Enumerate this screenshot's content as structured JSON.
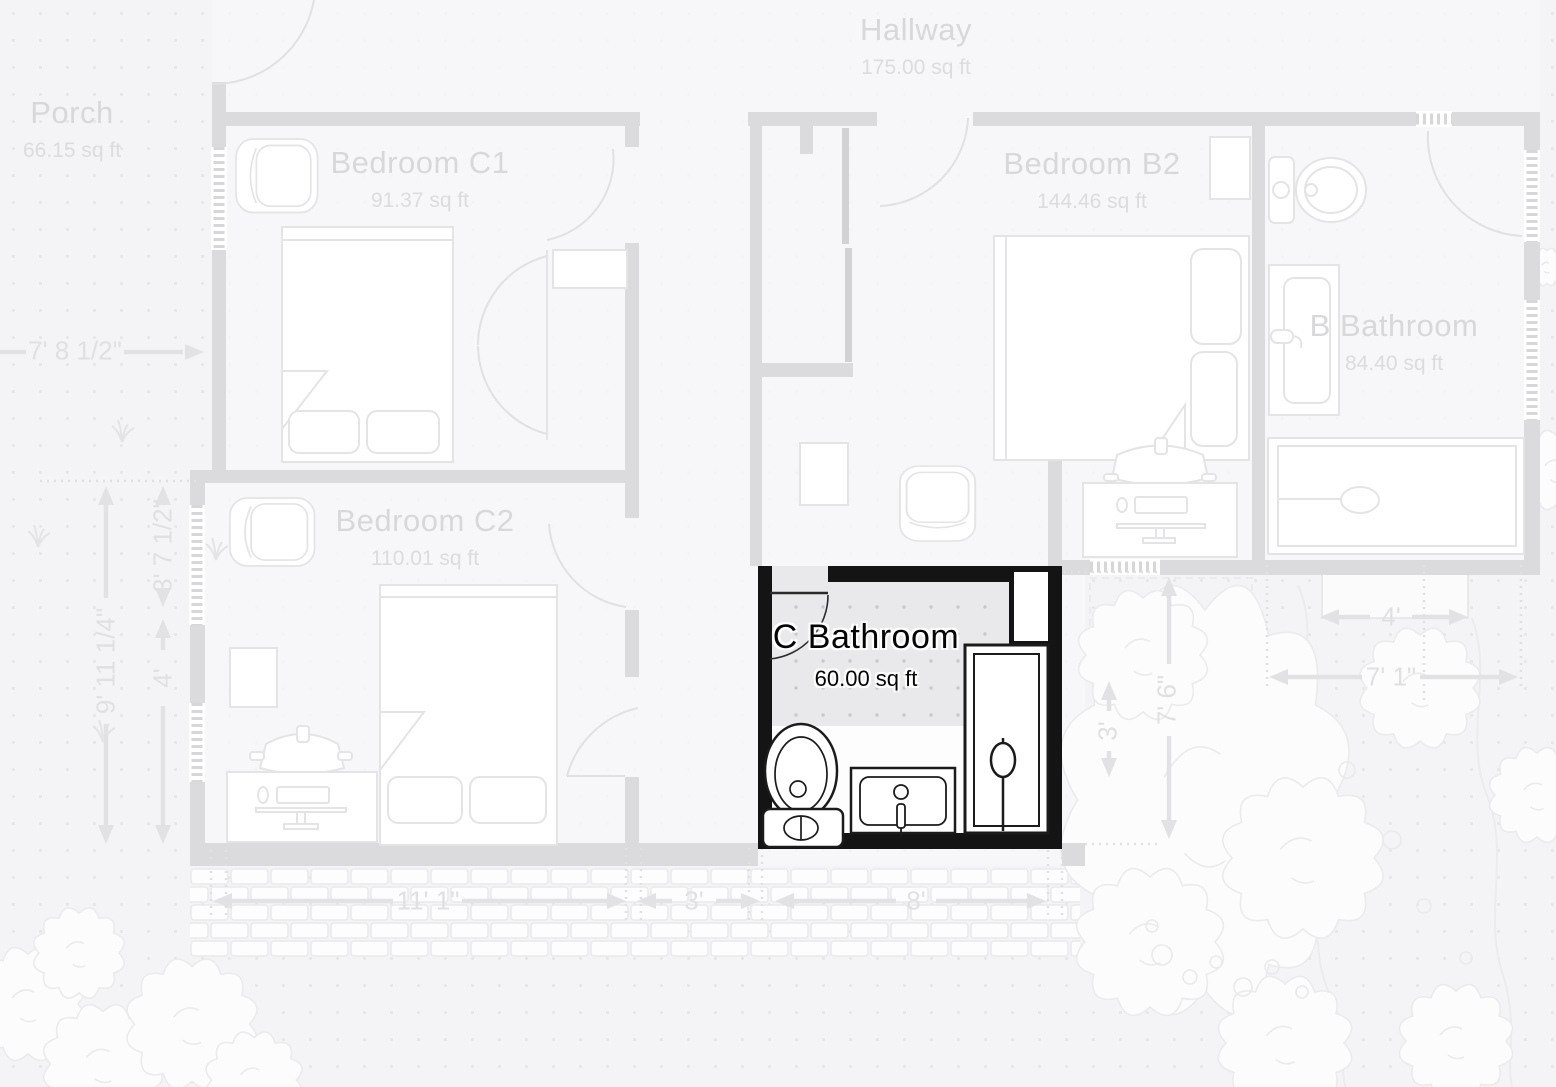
{
  "view": {
    "type": "floor-plan",
    "selected_room": "C Bathroom",
    "colors": {
      "selected_wall": "#141414",
      "faded_wall": "#dbdbdd",
      "background": "#f4f4f6",
      "faded_label": "#d8d8da",
      "selected_label": "#050505"
    }
  },
  "rooms": [
    {
      "name": "Porch",
      "area": "66.15 sq ft",
      "selected": false
    },
    {
      "name": "Hallway",
      "area": "175.00 sq ft",
      "selected": false
    },
    {
      "name": "Bedroom C1",
      "area": "91.37 sq ft",
      "selected": false
    },
    {
      "name": "Bedroom B2",
      "area": "144.46 sq ft",
      "selected": false
    },
    {
      "name": "B Bathroom",
      "area": "84.40 sq ft",
      "selected": false
    },
    {
      "name": "Bedroom C2",
      "area": "110.01 sq ft",
      "selected": false
    },
    {
      "name": "C Bathroom",
      "area": "60.00 sq ft",
      "selected": true
    }
  ],
  "dimensions": {
    "porch_width": "7' 8 1/2\"",
    "c2_side_upper": "3' 7 1/2\"",
    "c2_side_total": "9' 11 1/4\"",
    "c2_side_lower": "4'",
    "front_c2": "11' 1\"",
    "front_door": "3'",
    "front_c_bathroom": "8'",
    "garden_bed_top": "4'",
    "garden_width": "7' 1\"",
    "garden_height": "7' 6\"",
    "garden_side": "3'"
  }
}
